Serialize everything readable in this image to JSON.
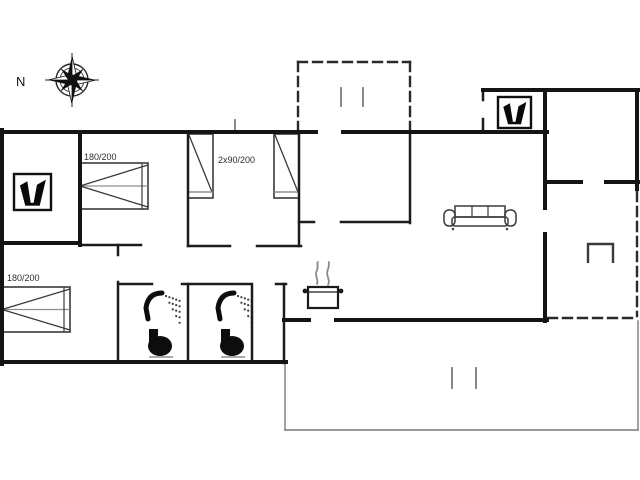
{
  "image": {
    "type": "holiday-house-floor-plan",
    "width": 640,
    "height": 480,
    "background": "#ffffff"
  },
  "colors": {
    "wall": "#141414",
    "inner_wall": "#1c1c1c",
    "furniture": "#3a3a3a",
    "light_line": "#8f8f8f",
    "terrace_line": "#7a7a7a",
    "dashed_wall": "#2a2a2a",
    "label": "#2e2e2e",
    "background": "#ffffff"
  },
  "compass": {
    "label": "N",
    "cx": 72,
    "cy": 80,
    "label_x": 16,
    "label_y": 86
  },
  "bed_labels": [
    {
      "text": "180/200",
      "x": 84,
      "y": 160
    },
    {
      "text": "2x90/200",
      "x": 218,
      "y": 163
    },
    {
      "text": "180/200",
      "x": 7,
      "y": 281
    }
  ],
  "beds": [
    {
      "name": "double-bed-1",
      "x": 80,
      "y": 163,
      "w": 68,
      "h": 46,
      "orient": "right"
    },
    {
      "name": "double-bed-2",
      "x": 2,
      "y": 287,
      "w": 68,
      "h": 45,
      "orient": "right"
    },
    {
      "name": "single-bed-1",
      "x": 188,
      "y": 134,
      "w": 25,
      "h": 64,
      "orient": "down"
    },
    {
      "name": "single-bed-2",
      "x": 274,
      "y": 134,
      "w": 25,
      "h": 64,
      "orient": "down"
    }
  ],
  "wood_stoves": [
    {
      "x": 14,
      "y": 174,
      "w": 37,
      "h": 36
    },
    {
      "x": 498,
      "y": 97,
      "w": 33,
      "h": 31
    }
  ],
  "bathrooms": [
    {
      "x": 136,
      "y": 289
    },
    {
      "x": 208,
      "y": 289
    }
  ],
  "sofa": {
    "x": 443,
    "y": 203,
    "w": 74,
    "h": 27
  },
  "cooktop": {
    "x": 308,
    "y": 262
  },
  "fireplace": {
    "x": 588,
    "y": 244,
    "w": 25,
    "h": 19
  },
  "walls": {
    "outer": [
      [
        2,
        130,
        2,
        364
      ],
      [
        2,
        132,
        316,
        132
      ],
      [
        343,
        132,
        547,
        132
      ],
      [
        483,
        90,
        639,
        90
      ],
      [
        637,
        90,
        637,
        189
      ],
      [
        545,
        90,
        545,
        182
      ],
      [
        2,
        362,
        286,
        362
      ],
      [
        284,
        320,
        309,
        320
      ],
      [
        336,
        320,
        547,
        320
      ],
      [
        545,
        182,
        545,
        208
      ],
      [
        545,
        234,
        545,
        321
      ],
      [
        545,
        182,
        581,
        182
      ],
      [
        606,
        182,
        639,
        182
      ],
      [
        2,
        243,
        80,
        243
      ],
      [
        80,
        132,
        80,
        245
      ]
    ],
    "inner": [
      [
        188,
        132,
        188,
        246
      ],
      [
        80,
        245,
        141,
        245
      ],
      [
        188,
        246,
        230,
        246
      ],
      [
        257,
        246,
        301,
        246
      ],
      [
        299,
        132,
        299,
        246
      ],
      [
        299,
        222,
        314,
        222
      ],
      [
        341,
        222,
        409,
        222
      ],
      [
        410,
        132,
        410,
        223
      ],
      [
        118,
        245,
        118,
        255
      ],
      [
        118,
        282,
        118,
        362
      ],
      [
        120,
        284,
        152,
        284
      ],
      [
        182,
        284,
        250,
        284
      ],
      [
        276,
        284,
        286,
        284
      ],
      [
        188,
        284,
        188,
        362
      ],
      [
        252,
        284,
        252,
        362
      ],
      [
        284,
        284,
        284,
        363
      ],
      [
        483,
        90,
        483,
        100
      ],
      [
        483,
        119,
        483,
        132
      ]
    ],
    "dashed": [
      [
        298,
        62,
        410,
        62
      ],
      [
        298,
        62,
        298,
        129
      ],
      [
        410,
        62,
        410,
        129
      ],
      [
        637,
        192,
        637,
        316
      ],
      [
        548,
        318,
        636,
        318
      ]
    ],
    "thin": [
      [
        285,
        363,
        285,
        430
      ],
      [
        285,
        430,
        638,
        430
      ],
      [
        638,
        430,
        638,
        321
      ]
    ],
    "marks": [
      [
        452,
        368,
        452,
        388
      ],
      [
        476,
        368,
        476,
        388
      ],
      [
        341,
        88,
        341,
        106
      ],
      [
        363,
        88,
        363,
        106
      ],
      [
        235,
        120,
        235,
        131
      ]
    ]
  }
}
